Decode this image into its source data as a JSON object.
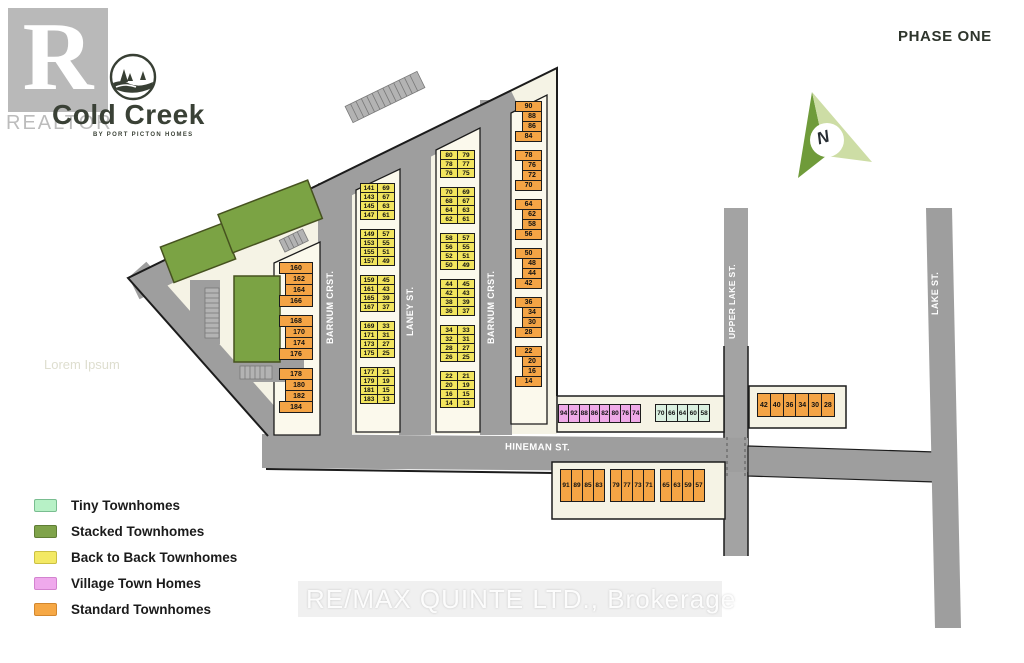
{
  "phase_label": "PHASE ONE",
  "brand": {
    "name": "Cold Creek",
    "tagline": "BY PORT PICTON HOMES"
  },
  "watermarks": {
    "realtor_letter": "R",
    "realtor": "REALTOR",
    "remax": "RE/MAX QUINTE LTD., Brokerage",
    "lorem": "Lorem Ipsum"
  },
  "north": {
    "label": "N"
  },
  "streets": {
    "barnum_west": "BARNUM CRST.",
    "laney": "LANEY ST.",
    "barnum_east": "BARNUM CRST.",
    "hineman": "HINEMAN ST.",
    "upper_lake": "UPPER LAKE ST.",
    "lake": "LAKE ST."
  },
  "legend": {
    "items": [
      {
        "label": "Tiny Townhomes",
        "color": "#b7f1c6",
        "border": "#79bd90"
      },
      {
        "label": "Stacked Townhomes",
        "color": "#7fa34a",
        "border": "#5f7d35"
      },
      {
        "label": "Back to Back Townhomes",
        "color": "#f3e964",
        "border": "#cbc043"
      },
      {
        "label": "Village Town Homes",
        "color": "#efa9ec",
        "border": "#d383cf"
      },
      {
        "label": "Standard Townhomes",
        "color": "#f6a845",
        "border": "#d2872e"
      }
    ]
  },
  "colors": {
    "parcel": "#f5f3e5",
    "road": "#9e9e9e",
    "outline": "#1c1c1c",
    "stacked_building": "#7ba344",
    "standard_lot": "#f4a445",
    "back_to_back_lot": "#f2e55e",
    "village_lot": "#efaae8",
    "tiny_lot": "#daf0e0"
  },
  "lots": {
    "barnum_west_orange": {
      "groups": [
        [
          "160",
          "162",
          "164",
          "166"
        ],
        [
          "168",
          "170",
          "174",
          "176"
        ],
        [
          "178",
          "180",
          "182",
          "184"
        ]
      ]
    },
    "back_to_back_west": {
      "groups": [
        [
          [
            "141",
            "69"
          ],
          [
            "143",
            "67"
          ],
          [
            "145",
            "63"
          ],
          [
            "147",
            "61"
          ]
        ],
        [
          [
            "149",
            "57"
          ],
          [
            "153",
            "55"
          ],
          [
            "155",
            "51"
          ],
          [
            "157",
            "49"
          ]
        ],
        [
          [
            "159",
            "45"
          ],
          [
            "161",
            "43"
          ],
          [
            "165",
            "39"
          ],
          [
            "167",
            "37"
          ]
        ],
        [
          [
            "169",
            "33"
          ],
          [
            "171",
            "31"
          ],
          [
            "173",
            "27"
          ],
          [
            "175",
            "25"
          ]
        ],
        [
          [
            "177",
            "21"
          ],
          [
            "179",
            "19"
          ],
          [
            "181",
            "15"
          ],
          [
            "183",
            "13"
          ]
        ]
      ]
    },
    "back_to_back_east": {
      "groups": [
        [
          [
            "80",
            "79"
          ],
          [
            "78",
            "77"
          ],
          [
            "76",
            "75"
          ]
        ],
        [
          [
            "70",
            "69"
          ],
          [
            "68",
            "67"
          ],
          [
            "64",
            "63"
          ],
          [
            "62",
            "61"
          ]
        ],
        [
          [
            "58",
            "57"
          ],
          [
            "56",
            "55"
          ],
          [
            "52",
            "51"
          ],
          [
            "50",
            "49"
          ]
        ],
        [
          [
            "44",
            "45"
          ],
          [
            "42",
            "43"
          ],
          [
            "38",
            "39"
          ],
          [
            "36",
            "37"
          ]
        ],
        [
          [
            "34",
            "33"
          ],
          [
            "32",
            "31"
          ],
          [
            "28",
            "27"
          ],
          [
            "26",
            "25"
          ]
        ],
        [
          [
            "22",
            "21"
          ],
          [
            "20",
            "19"
          ],
          [
            "16",
            "15"
          ],
          [
            "14",
            "13"
          ]
        ]
      ]
    },
    "barnum_east_orange": {
      "groups": [
        [
          "90",
          "88",
          "86",
          "84"
        ],
        [
          "78",
          "76",
          "72",
          "70"
        ],
        [
          "64",
          "62",
          "58",
          "56"
        ],
        [
          "50",
          "48",
          "44",
          "42"
        ],
        [
          "36",
          "34",
          "30",
          "28"
        ],
        [
          "22",
          "20",
          "16",
          "14"
        ]
      ]
    },
    "village_row": [
      "94",
      "92",
      "88",
      "86",
      "82",
      "80",
      "76",
      "74"
    ],
    "tiny_row": [
      "70",
      "66",
      "64",
      "60",
      "58"
    ],
    "upper_lake_row": [
      "42",
      "40",
      "36",
      "34",
      "30",
      "28"
    ],
    "hineman_south": {
      "groups": [
        [
          "91",
          "89",
          "85",
          "83"
        ],
        [
          "79",
          "77",
          "73",
          "71"
        ],
        [
          "65",
          "63",
          "59",
          "57"
        ]
      ]
    }
  }
}
